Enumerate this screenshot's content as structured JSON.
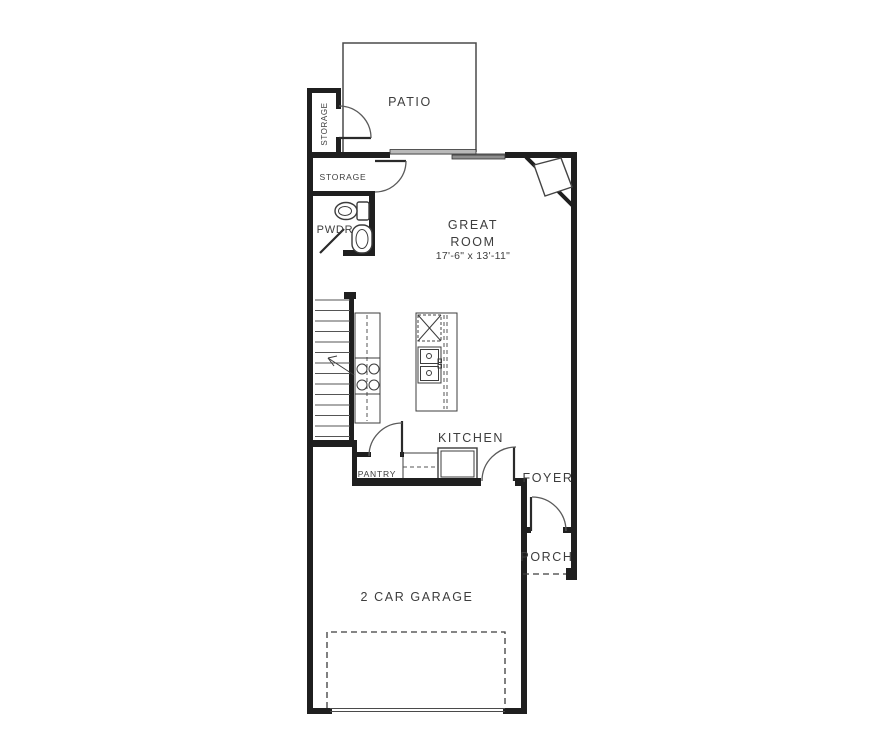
{
  "rooms": {
    "patio": {
      "label": "PATIO"
    },
    "storage_exterior": {
      "label": "STORAGE"
    },
    "storage_interior": {
      "label": "STORAGE"
    },
    "powder": {
      "label": "PWDR"
    },
    "great_room": {
      "label_line1": "GREAT",
      "label_line2": "ROOM",
      "dimensions": "17'-6\" x 13'-11\""
    },
    "kitchen": {
      "label": "KITCHEN"
    },
    "pantry": {
      "label": "PANTRY"
    },
    "foyer": {
      "label": "FOYER"
    },
    "porch": {
      "label": "PORCH"
    },
    "garage": {
      "label": "2 CAR GARAGE"
    }
  },
  "fixtures": [
    "toilet",
    "bathroom-sink",
    "staircase",
    "stair-direction-arrow",
    "range-cooktop",
    "kitchen-counter",
    "kitchen-island",
    "dishwasher",
    "double-sink",
    "refrigerator",
    "corner-fireplace",
    "sliding-glass-door",
    "garage-door-dashed-outline",
    "porch-edge-dashed"
  ],
  "colors": {
    "wall": "#1f1f1f",
    "line": "#4a4a4a",
    "text": "#3d3d3d",
    "background": "#ffffff",
    "window": "#b9b9b9"
  }
}
